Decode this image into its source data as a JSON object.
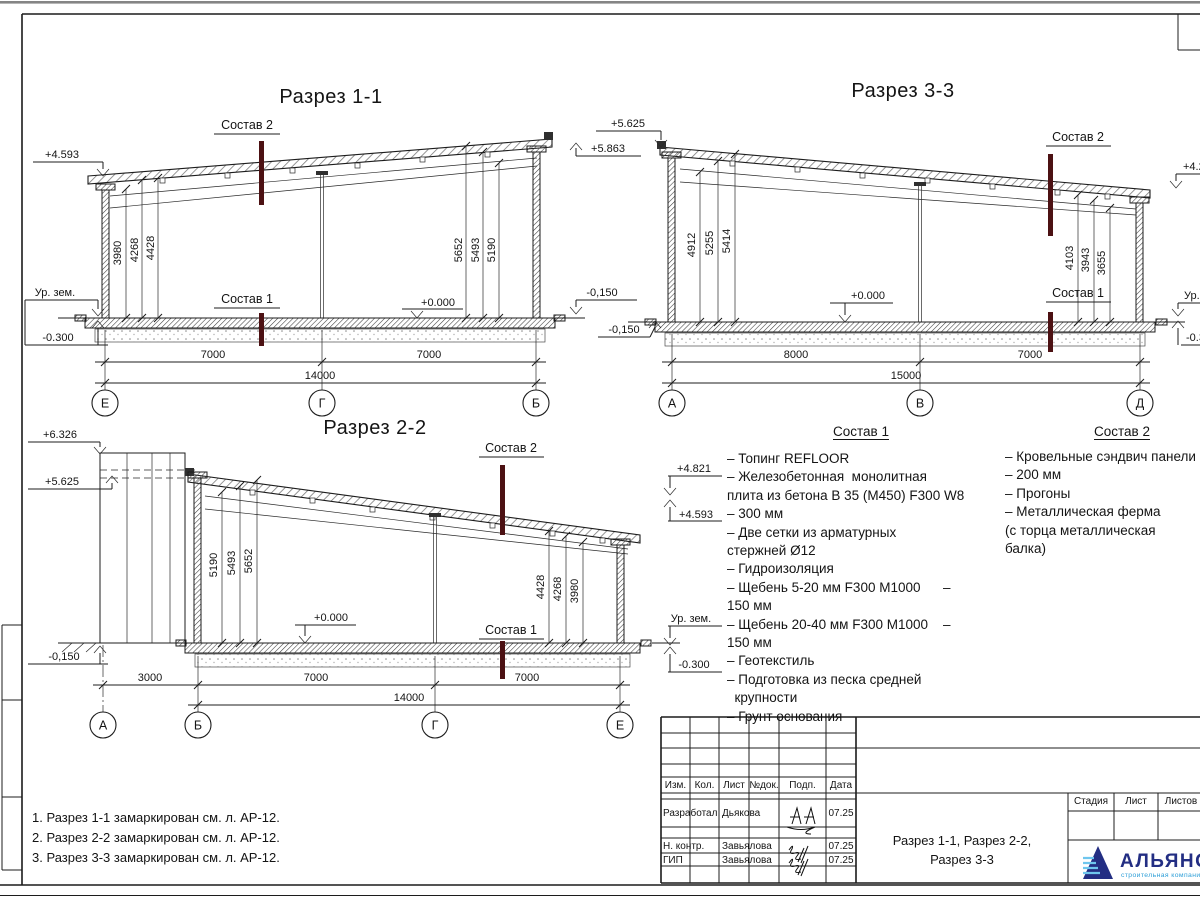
{
  "sections": {
    "s1": {
      "title": "Разрез 1-1",
      "axes": [
        "Е",
        "Г",
        "Б"
      ],
      "dims_left": [
        "3980",
        "4268",
        "4428"
      ],
      "dims_right": [
        "5652",
        "5493",
        "5190"
      ],
      "dims_bottom": [
        "7000",
        "7000"
      ],
      "dim_total": "14000",
      "zero": "+0.000",
      "sostav1": "Состав 1",
      "sostav2": "Состав 2",
      "elev_left_top": "+4.593",
      "elev_ground": "Ур. зем.",
      "elev_below": "-0.300",
      "elev_right_top": "+5.863",
      "elev_right_bottom": "-0,150"
    },
    "s3": {
      "title": "Разрез 3-3",
      "axes": [
        "А",
        "В",
        "Д"
      ],
      "dims_left": [
        "4912",
        "5255",
        "5414"
      ],
      "dims_right": [
        "4103",
        "3943",
        "3655"
      ],
      "dims_bottom": [
        "8000",
        "7000"
      ],
      "dim_total": "15000",
      "zero": "+0.000",
      "sostav1": "Состав 1",
      "sostav2": "Состав 2",
      "elev_left_top": "+5.625",
      "elev_left_bottom": "-0,150",
      "elev_right_top": "+4.2",
      "elev_right_ground": "Ур.",
      "elev_right_below": "-0.3"
    },
    "s2": {
      "title": "Разрез 2-2",
      "axes": [
        "А",
        "Б",
        "Г",
        "Е"
      ],
      "dims_left": [
        "5190",
        "5493",
        "5652"
      ],
      "dims_right": [
        "4428",
        "4268",
        "3980"
      ],
      "dims_bottom": [
        "3000",
        "7000",
        "7000"
      ],
      "dim_total": "14000",
      "zero": "+0.000",
      "sostav1": "Состав 1",
      "sostav2": "Состав 2",
      "elev_left_top": "+6.326",
      "elev_left_mid": "+5.625",
      "elev_left_bottom": "-0,150"
    }
  },
  "sostav1_block": {
    "title": "Состав 1",
    "lines": [
      "– Топинг REFLOOR",
      "– Железобетонная  монолитная",
      "плита из бетона В 35 (М450) F300 W8",
      "– 300 мм",
      "– Две сетки из арматурных",
      "стержней Ø12",
      "– Гидроизоляция",
      "– Щебень 5-20 мм F300 М1000      –",
      "150 мм",
      "– Щебень 20-40 мм F300 М1000    –",
      "150 мм",
      "– Геотекстиль",
      "– Подготовка из песка средней",
      "  крупности",
      "– Грунт основания"
    ],
    "mark_top_upper": "+4.821",
    "mark_top_lower": "+4.593",
    "mark_ground": "Ур. зем.",
    "mark_below": "-0.300"
  },
  "sostav2_block": {
    "title": "Состав 2",
    "lines": [
      "– Кровельные сэндвич панели",
      "– 200 мм",
      "– Прогоны",
      "– Металлическая ферма",
      "(с торца металлическая",
      "балка)"
    ]
  },
  "notes": [
    "1. Разрез 1-1 замаркирован см. л. АР-12.",
    "2. Разрез 2-2 замаркирован см. л. АР-12.",
    "3. Разрез 3-3 замаркирован см. л. АР-12."
  ],
  "titleblock": {
    "headers": [
      "Изм.",
      "Кол.",
      "Лист",
      "№док.",
      "Подп.",
      "Дата"
    ],
    "rows": [
      {
        "role": "Разработал",
        "name": "Дьякова",
        "date": "07.25"
      },
      {
        "role": "Н. контр.",
        "name": "Завьялова",
        "date": "07.25"
      },
      {
        "role": "ГИП",
        "name": "Завьялова",
        "date": "07.25"
      }
    ],
    "doc_title_line1": "Разрез 1-1, Разрез 2-2,",
    "doc_title_line2": "Разрез 3-3",
    "stage_headers": [
      "Стадия",
      "Лист",
      "Листов"
    ],
    "logo_text": "АЛЬЯНС",
    "logo_sub": "строительная компания"
  },
  "colors": {
    "marker": "#4c1113",
    "logo_navy": "#232e83",
    "logo_blue": "#2e9fd8"
  }
}
